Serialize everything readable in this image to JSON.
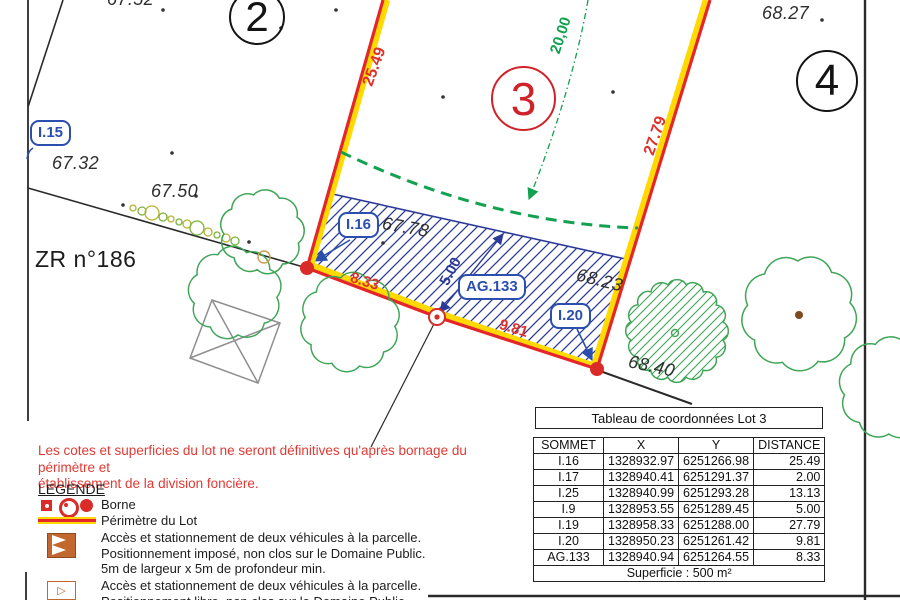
{
  "plan": {
    "parcel_numbers": {
      "lot2": "2",
      "lot3": "3",
      "lot4": "4"
    },
    "zone_label": "ZR n°186",
    "point_labels": {
      "i15": "I.15",
      "i16": "I.16",
      "ag133": "AG.133",
      "i20": "I.20"
    },
    "dimensions": {
      "left_edge": "25.49",
      "right_edge": "27.79",
      "bottom_left": "8.33",
      "bottom_right": "9.81",
      "band_depth": "5.00",
      "setback": "20,00"
    },
    "elevations": {
      "top_left": "67.52",
      "near_i15": "67.32",
      "mid_left": "67.50",
      "near_i16": "67.78",
      "near_i20": "68.23",
      "below_i20": "68.40",
      "top_right": "68.27"
    }
  },
  "notice": "Les cotes et superficies du lot ne seront définitives qu'après bornage du périmètre et\nétablissement de la division foncière.",
  "legend": {
    "title": "LEGENDE",
    "borne_label": "Borne",
    "perimeter_label": "Périmètre du Lot",
    "access_imposed": "Accès et stationnement de deux véhicules à la parcelle.\nPositionnement imposé, non clos sur le Domaine Public.\n5m de largeur x 5m de profondeur min.",
    "access_free": "Accès et stationnement de deux véhicules à la parcelle.\nPositionnement libre, non clos sur le Domaine Public.",
    "access2_glyph": "▷"
  },
  "coord_table": {
    "title": "Tableau de coordonnées Lot 3",
    "headers": [
      "SOMMET",
      "X",
      "Y",
      "DISTANCE"
    ],
    "rows": [
      [
        "I.16",
        "1328932.97",
        "6251266.98",
        "25.49"
      ],
      [
        "I.17",
        "1328940.41",
        "6251291.37",
        "2.00"
      ],
      [
        "I.25",
        "1328940.99",
        "6251293.28",
        "13.13"
      ],
      [
        "I.9",
        "1328953.55",
        "6251289.45",
        "5.00"
      ],
      [
        "I.19",
        "1328958.33",
        "6251288.00",
        "27.79"
      ],
      [
        "I.20",
        "1328950.23",
        "6251261.42",
        "9.81"
      ],
      [
        "AG.133",
        "1328940.94",
        "6251264.55",
        "8.33"
      ]
    ],
    "footer": "Superficie : 500 m²"
  },
  "colors": {
    "perimeter_red": "#e4262a",
    "perimeter_yellow": "#ffd900",
    "hatch_blue": "#2b3a96",
    "label_blue": "#2b4fae",
    "tree_green": "#3fa557",
    "dashed_green": "#12a150",
    "borne_red": "#d92b27",
    "notice_red": "#e03a34",
    "black_line": "#2a2a2a"
  }
}
